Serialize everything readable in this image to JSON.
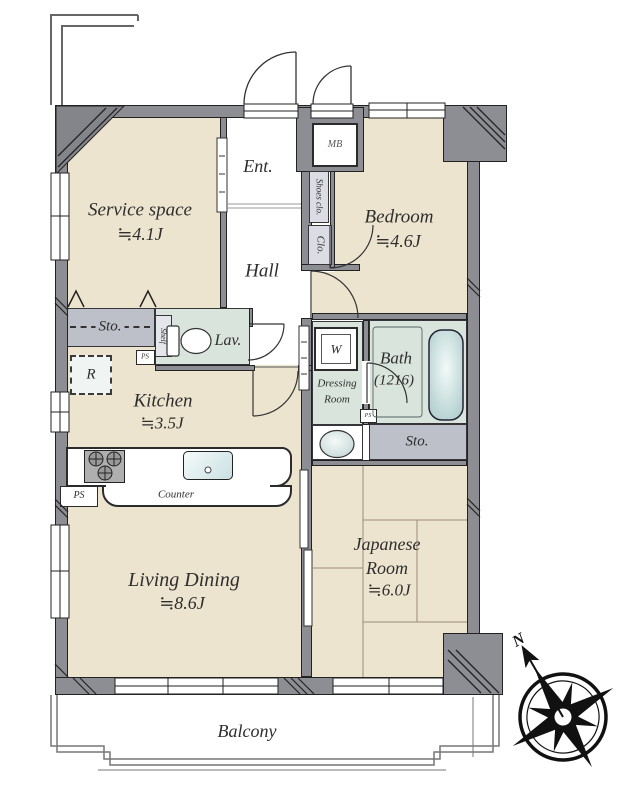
{
  "rooms": {
    "entrance": {
      "label": "Ent."
    },
    "hall": {
      "label": "Hall"
    },
    "service_space": {
      "label": "Service space",
      "size": "≒4.1J"
    },
    "bedroom": {
      "label": "Bedroom",
      "size": "≒4.6J"
    },
    "kitchen": {
      "label": "Kitchen",
      "size": "≒3.5J"
    },
    "living_dining": {
      "label": "Living Dining",
      "size": "≒8.6J"
    },
    "japanese_room": {
      "label_line1": "Japanese",
      "label_line2": "Room",
      "size": "≒6.0J"
    },
    "bath": {
      "label": "Bath",
      "size": "(1216)"
    },
    "dressing_room": {
      "label_line1": "Dressing",
      "label_line2": "Room"
    },
    "lavatory": {
      "label": "Lav."
    },
    "balcony": {
      "label": "Balcony"
    }
  },
  "fixtures": {
    "meter_box": {
      "label": "MB"
    },
    "shoes_closet": {
      "label": "Shoes clo."
    },
    "closet": {
      "label": "Clo."
    },
    "storage_hall": {
      "label": "Sto."
    },
    "storage_japanese": {
      "label": "Sto."
    },
    "shelf": {
      "label": "Shelf"
    },
    "refrigerator": {
      "label": "R"
    },
    "washing_machine": {
      "label": "W"
    },
    "counter": {
      "label": "Counter"
    },
    "pipe_space_lav": {
      "label": "PS"
    },
    "pipe_space_kitchen": {
      "label": "PS"
    },
    "pipe_space_bath": {
      "label": "PS"
    }
  },
  "compass": {
    "north": "N"
  },
  "colors": {
    "wall": "#8D8E94",
    "floor": "#EDE4CF",
    "wet_area": "#D9E4DC",
    "storage": "#BDC0C9",
    "tub": "#A9C9C9"
  }
}
